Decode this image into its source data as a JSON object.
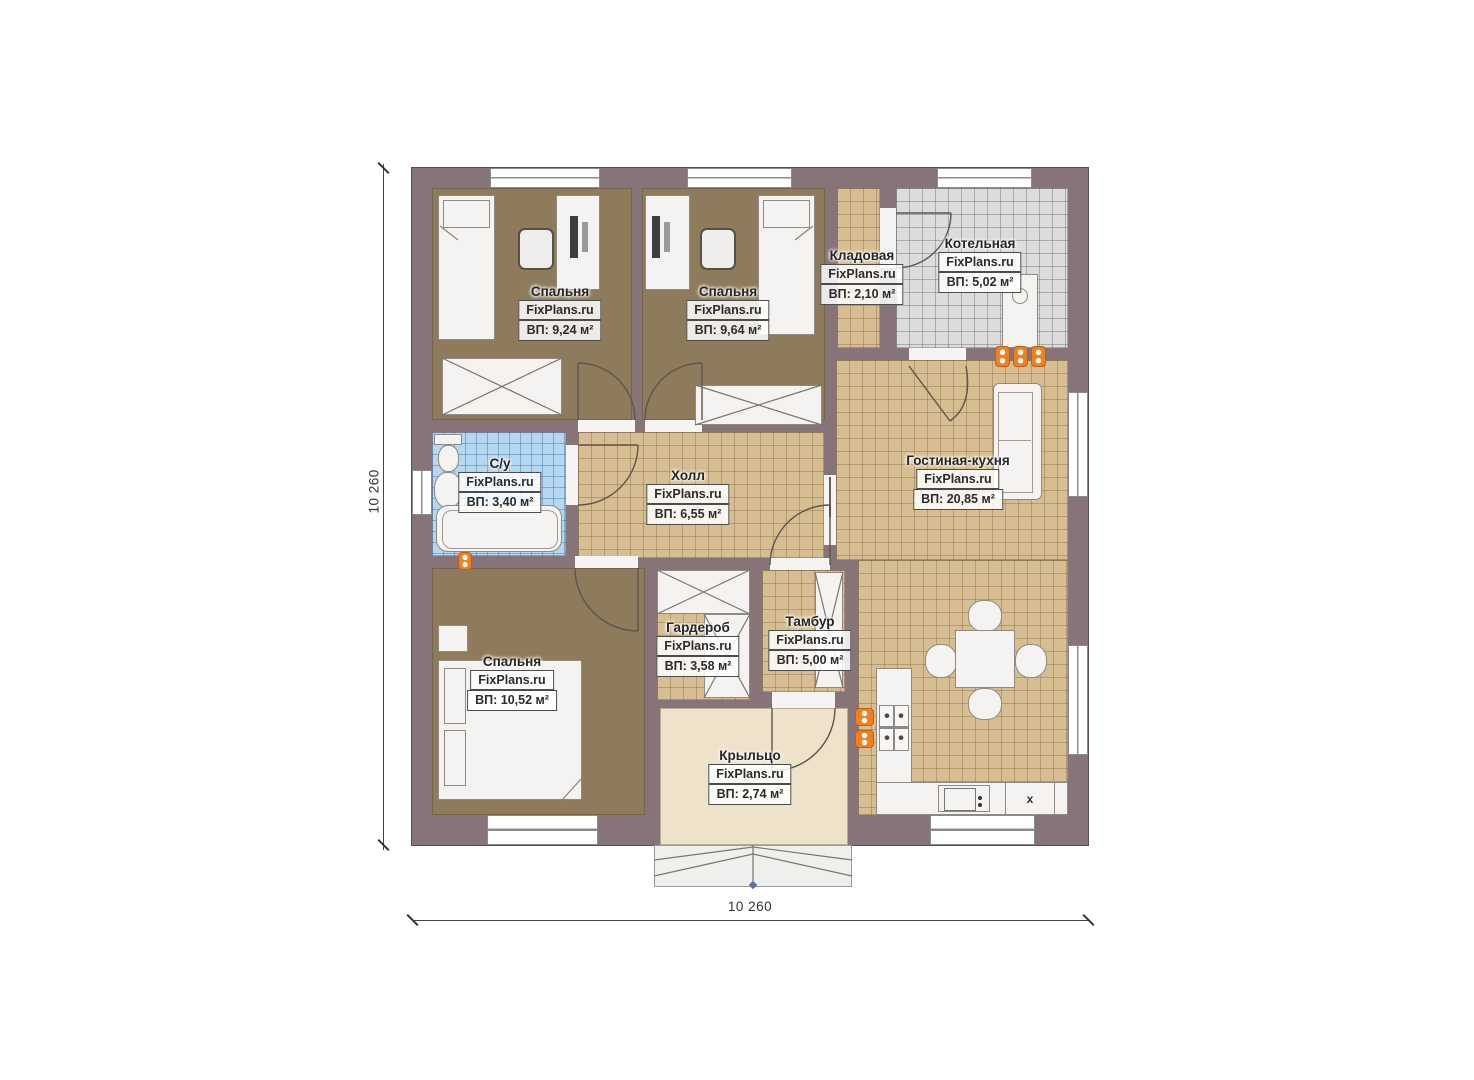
{
  "plan": {
    "watermark": "FixPlans.ru",
    "dim_width": "10 260",
    "dim_height": "10 260",
    "appliance_label": "x",
    "colors": {
      "wall": "#877479",
      "carpet_floor": "#8d7b5b",
      "tile_floor": "#d7be92",
      "boiler_tile_floor": "#dcdcdc",
      "bathroom_tile_floor": "#b4d7f2",
      "porch_floor": "#eee2cb",
      "radiator": "#f07f1e"
    },
    "rooms": [
      {
        "name": "Спальня",
        "area": "ВП: 9,24 м²"
      },
      {
        "name": "Спальня",
        "area": "ВП: 9,64 м²"
      },
      {
        "name": "Кладовая",
        "area": "ВП: 2,10 м²"
      },
      {
        "name": "Котельная",
        "area": "ВП: 5,02 м²"
      },
      {
        "name": "С/у",
        "area": "ВП: 3,40 м²"
      },
      {
        "name": "Холл",
        "area": "ВП: 6,55 м²"
      },
      {
        "name": "Гостиная-кухня",
        "area": "ВП: 20,85 м²"
      },
      {
        "name": "Спальня",
        "area": "ВП: 10,52 м²"
      },
      {
        "name": "Гардероб",
        "area": "ВП: 3,58 м²"
      },
      {
        "name": "Тамбур",
        "area": "ВП: 5,00 м²"
      },
      {
        "name": "Крыльцо",
        "area": "ВП: 2,74 м²"
      }
    ]
  }
}
